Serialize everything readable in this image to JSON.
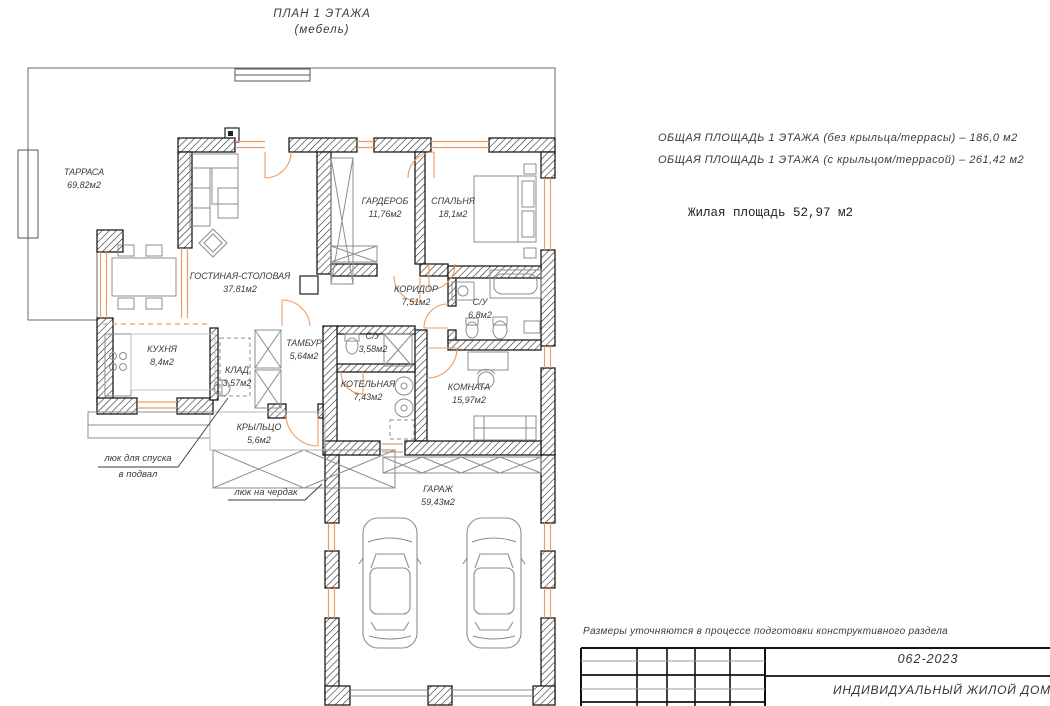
{
  "title": {
    "line1": "ПЛАН 1 ЭТАЖА",
    "line2": "(мебель)"
  },
  "summary": {
    "line1": "ОБЩАЯ ПЛОЩАДЬ 1 ЭТАЖА (без крыльца/террасы) – 186,0 м2",
    "line2": "ОБЩАЯ ПЛОЩАДЬ 1 ЭТАЖА (с крыльцом/террасой) – 261,42 м2",
    "living_area": "Жилая площадь 52,97 м2"
  },
  "rooms": {
    "terrace": {
      "name": "ТАРРАСА",
      "area": "69,82м2"
    },
    "living": {
      "name": "ГОСТИНАЯ-СТОЛОВАЯ",
      "area": "37,81м2"
    },
    "wardrobe": {
      "name": "ГАРДЕРОБ",
      "area": "11,76м2"
    },
    "bedroom": {
      "name": "СПАЛЬНЯ",
      "area": "18,1м2"
    },
    "corridor": {
      "name": "КОРИДОР",
      "area": "7,51м2"
    },
    "bath1": {
      "name": "С/У",
      "area": "6,8м2"
    },
    "kitchen": {
      "name": "КУХНЯ",
      "area": "8,4м2"
    },
    "pantry": {
      "name": "КЛАД",
      "area": "3,57м2"
    },
    "vestibule": {
      "name": "ТАМБУР",
      "area": "5,64м2"
    },
    "bath2": {
      "name": "С/У",
      "area": "3,58м2"
    },
    "boiler": {
      "name": "КОТЕЛЬНАЯ",
      "area": "7,43м2"
    },
    "room": {
      "name": "КОМНАТА",
      "area": "15,97м2"
    },
    "porch": {
      "name": "КРЫЛЬЦО",
      "area": "5,6м2"
    },
    "garage": {
      "name": "ГАРАЖ",
      "area": "59,43м2"
    }
  },
  "annotations": {
    "basement_hatch_line1": "люк для спуска",
    "basement_hatch_line2": "в подвал",
    "attic_hatch": "люк на чердак"
  },
  "footer": {
    "note": "Размеры уточняются в процессе подготовки конструктивного раздела",
    "doc_number": "062-2023",
    "doc_title": "ИНДИВИДУАЛЬНЫЙ ЖИЛОЙ ДОМ"
  },
  "colors": {
    "accent_orange": "#EC9C60",
    "wall_black": "#1d1d1d",
    "furniture_gray": "#8d8d8d"
  }
}
